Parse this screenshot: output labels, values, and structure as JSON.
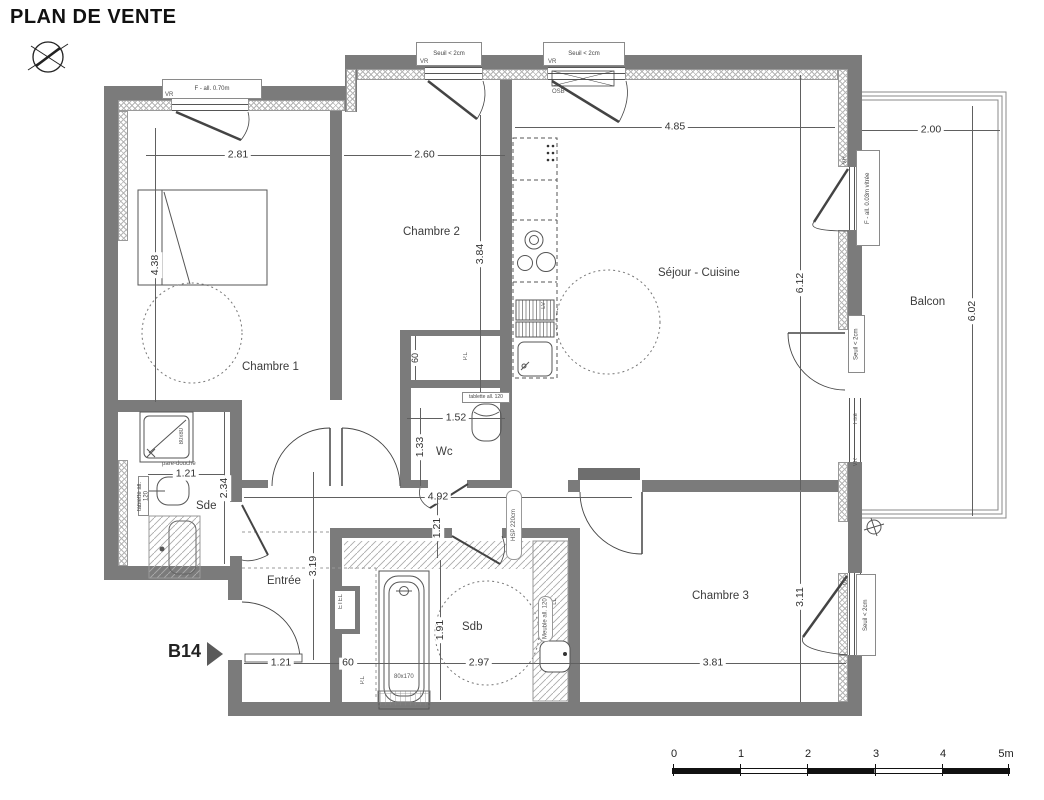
{
  "title": "PLAN DE VENTE",
  "compass": {
    "north": "N"
  },
  "unit": {
    "code": "B14"
  },
  "rooms": {
    "chambre1": "Chambre 1",
    "chambre2": "Chambre 2",
    "sejour": "Séjour - Cuisine",
    "balcon": "Balcon",
    "sde": "Sde",
    "wc": "Wc",
    "entree": "Entrée",
    "sdb": "Sdb",
    "chambre3": "Chambre 3"
  },
  "dims": {
    "ch1_w": "2.81",
    "ch2_w": "2.60",
    "ch2_h": "3.84",
    "sej_w": "4.85",
    "balc_w": "2.00",
    "ch1_h": "4.38",
    "sej_h": "6.12",
    "balc_h": "6.02",
    "wc_w": "1.52",
    "wc_h": "1.33",
    "sde_w": "1.21",
    "sde_h": "2.34",
    "corr_w": "4.92",
    "corr_h": "1.21",
    "entree_h": "3.19",
    "door_w": "1.21",
    "etel_w": "60",
    "sdb_w": "2.97",
    "ch3_w": "3.81",
    "ch3_h": "3.11",
    "sdb_h": "1.91",
    "pl_d": "60"
  },
  "openings": {
    "f070": "F - all. 0.70m",
    "seuil": "Seuil < 2cm",
    "vr": "VR",
    "osb": "OSB",
    "f003": "F - all. 0.03m vitrée",
    "fixe": "Fixe"
  },
  "fixtures": {
    "shower": "80x80",
    "pare_douche": "pare-douche",
    "tablette": "tablette all. 120",
    "bath": "80x170",
    "lv": "LV",
    "ll": "LL",
    "etel": "ETEL",
    "pl": "P.L",
    "hsp": "HSP 220cm",
    "meuble": "Meuble all. 120"
  },
  "scale_bar": {
    "ticks": [
      "0",
      "1",
      "2",
      "3",
      "4",
      "5m"
    ]
  }
}
